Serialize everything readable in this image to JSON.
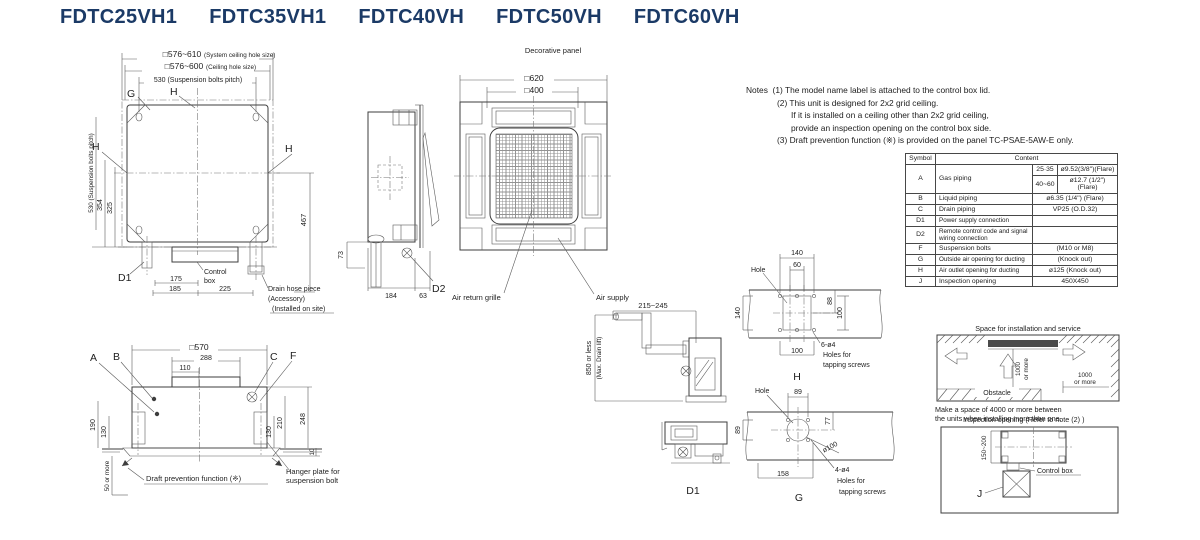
{
  "title": {
    "models": [
      "FDTC25VH1",
      "FDTC35VH1",
      "FDTC40VH",
      "FDTC50VH",
      "FDTC60VH"
    ]
  },
  "plan_view": {
    "dim_system_hole": "□576~610",
    "dim_system_hole_note": "(System ceiling hole size)",
    "dim_ceiling_hole": "□576~600",
    "dim_ceiling_hole_note": "(Ceiling hole size)",
    "dim_bolt_pitch_h": "530 (Suspension bolts pitch)",
    "dim_bolt_pitch_v": "530 (Suspension bolts pitch)",
    "dim_354": "354",
    "dim_325": "325",
    "dim_467": "467",
    "dim_175": "175",
    "dim_185": "185",
    "dim_225": "225",
    "label_g": "G",
    "label_h": "H",
    "label_d1": "D1",
    "control_1": "Control",
    "control_2": "box",
    "drain_hose_1": "Drain hose piece",
    "drain_hose_2": "(Accessory)",
    "drain_hose_3": "(Installed on site)"
  },
  "side_view": {
    "dim_73": "73",
    "dim_184": "184",
    "dim_63": "63",
    "label_d2": "D2"
  },
  "panel_view": {
    "title": "Decorative panel",
    "dim_620": "□620",
    "dim_400": "□400",
    "air_return": "Air return grille",
    "air_supply": "Air supply"
  },
  "notes": {
    "label": "Notes",
    "lines": [
      "(1) The model name label is attached to the control box lid.",
      "(2) This unit is designed for 2x2 grid ceiling.",
      "If it is installed on a ceiling other than 2x2 grid ceiling,",
      "provide an inspection opening on the control box side.",
      "(3) Draft prevention function (※) is provided on the panel TC-PSAE-5AW-E only."
    ]
  },
  "symbol_table": {
    "header_symbol": "Symbol",
    "header_content": "Content",
    "a_symbol": "A",
    "a_name": "Gas piping",
    "a_range1": "25·35",
    "a_value1": "ø9.52(3/8\")(Flare)",
    "a_range2": "40~60",
    "a_value2a": "ø12.7 (1/2\")",
    "a_value2b": "(Flare)",
    "b_symbol": "B",
    "b_name": "Liquid piping",
    "b_value": "ø6.35 (1/4\")  (Flare)",
    "c_symbol": "C",
    "c_name": "Drain piping",
    "c_value": "VP25 (O.D.32)",
    "d1_symbol": "D1",
    "d1_name": "Power supply connection",
    "d1_value": "",
    "d2_symbol": "D2",
    "d2_name": "Remote control code and signal wiring connection",
    "d2_value": "",
    "f_symbol": "F",
    "f_name": "Suspension bolts",
    "f_value": "(M10 or M8)",
    "g_symbol": "G",
    "g_name": "Outside air opening for ducting",
    "g_value": "(Knock out)",
    "h_symbol": "H",
    "h_name": "Air outlet opening for ducting",
    "h_value": "ø125 (Knock out)",
    "j_symbol": "J",
    "j_name": "Inspection opening",
    "j_value": "450X450"
  },
  "front_view": {
    "dim_570": "□570",
    "dim_288": "288",
    "dim_110": "110",
    "label_a": "A",
    "label_b": "B",
    "label_c": "C",
    "label_f": "F",
    "dim_190": "190",
    "dim_130l": "130",
    "dim_50": "50 or more",
    "dim_248": "248",
    "dim_210": "210",
    "dim_130r": "130",
    "dim_10": "10",
    "draft_note": "Draft prevention function (※)",
    "hanger_1": "Hanger plate for",
    "hanger_2": "suspension bolt"
  },
  "drain_view": {
    "dim_range": "215~245",
    "dim_lift_1": "850 or less",
    "dim_lift_2": "(Max. Drain lift)",
    "label_d1": "D1"
  },
  "hole_h": {
    "label_hole": "Hole",
    "dim_140t": "140",
    "dim_60": "60",
    "dim_88": "88",
    "dim_140l": "140",
    "dim_100r": "100",
    "dim_100b": "100",
    "screws_1": "6-ø4",
    "screws_2": "Holes for",
    "screws_3": "tapping screws",
    "label": "H"
  },
  "hole_g": {
    "label_hole": "Hole",
    "dim_89t": "89",
    "dim_89l": "89",
    "dim_77": "77",
    "dim_d100": "ø100",
    "dim_158": "158",
    "screws_1": "4-ø4",
    "screws_2": "Holes for",
    "screws_3": "tapping screws",
    "label": "G"
  },
  "space_view": {
    "title": "Space for installation and service",
    "dim_1000a": "1000",
    "or_more_a": "or more",
    "dim_1000b": "1000",
    "or_more_b": "or more",
    "obstacle": "Obstacle",
    "caption_1": "Make a space of 4000 or more between",
    "caption_2": "the units when installing more than one."
  },
  "inspection_view": {
    "title": "Inspection opening (Refer to note (2) )",
    "dim_range": "150~200",
    "control_box": "Control box",
    "label_j": "J"
  },
  "colors": {
    "title": "#1b3a66",
    "line": "#3d3d3d"
  }
}
